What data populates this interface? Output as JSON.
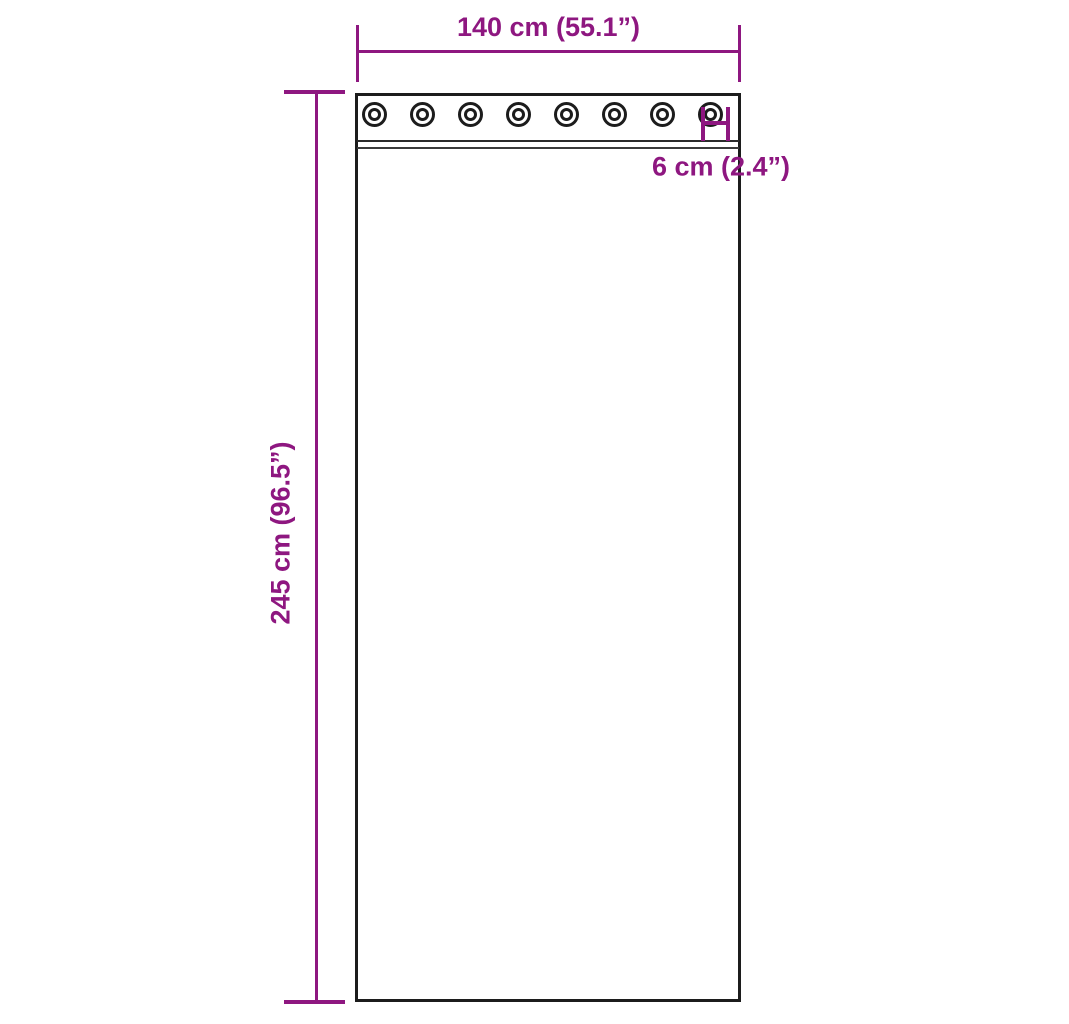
{
  "diagram": {
    "type": "product-dimension-diagram",
    "subject": "curtain-panel-with-grommets",
    "dimensions": {
      "width_label": "140 cm (55.1”)",
      "height_label": "245 cm (96.5”)",
      "grommet_label": "6 cm (2.4”)"
    },
    "grommets": {
      "count": 8
    },
    "colors": {
      "dimension_accent": "#8e1780",
      "outline": "#1c1c1c",
      "background": "#ffffff"
    }
  }
}
